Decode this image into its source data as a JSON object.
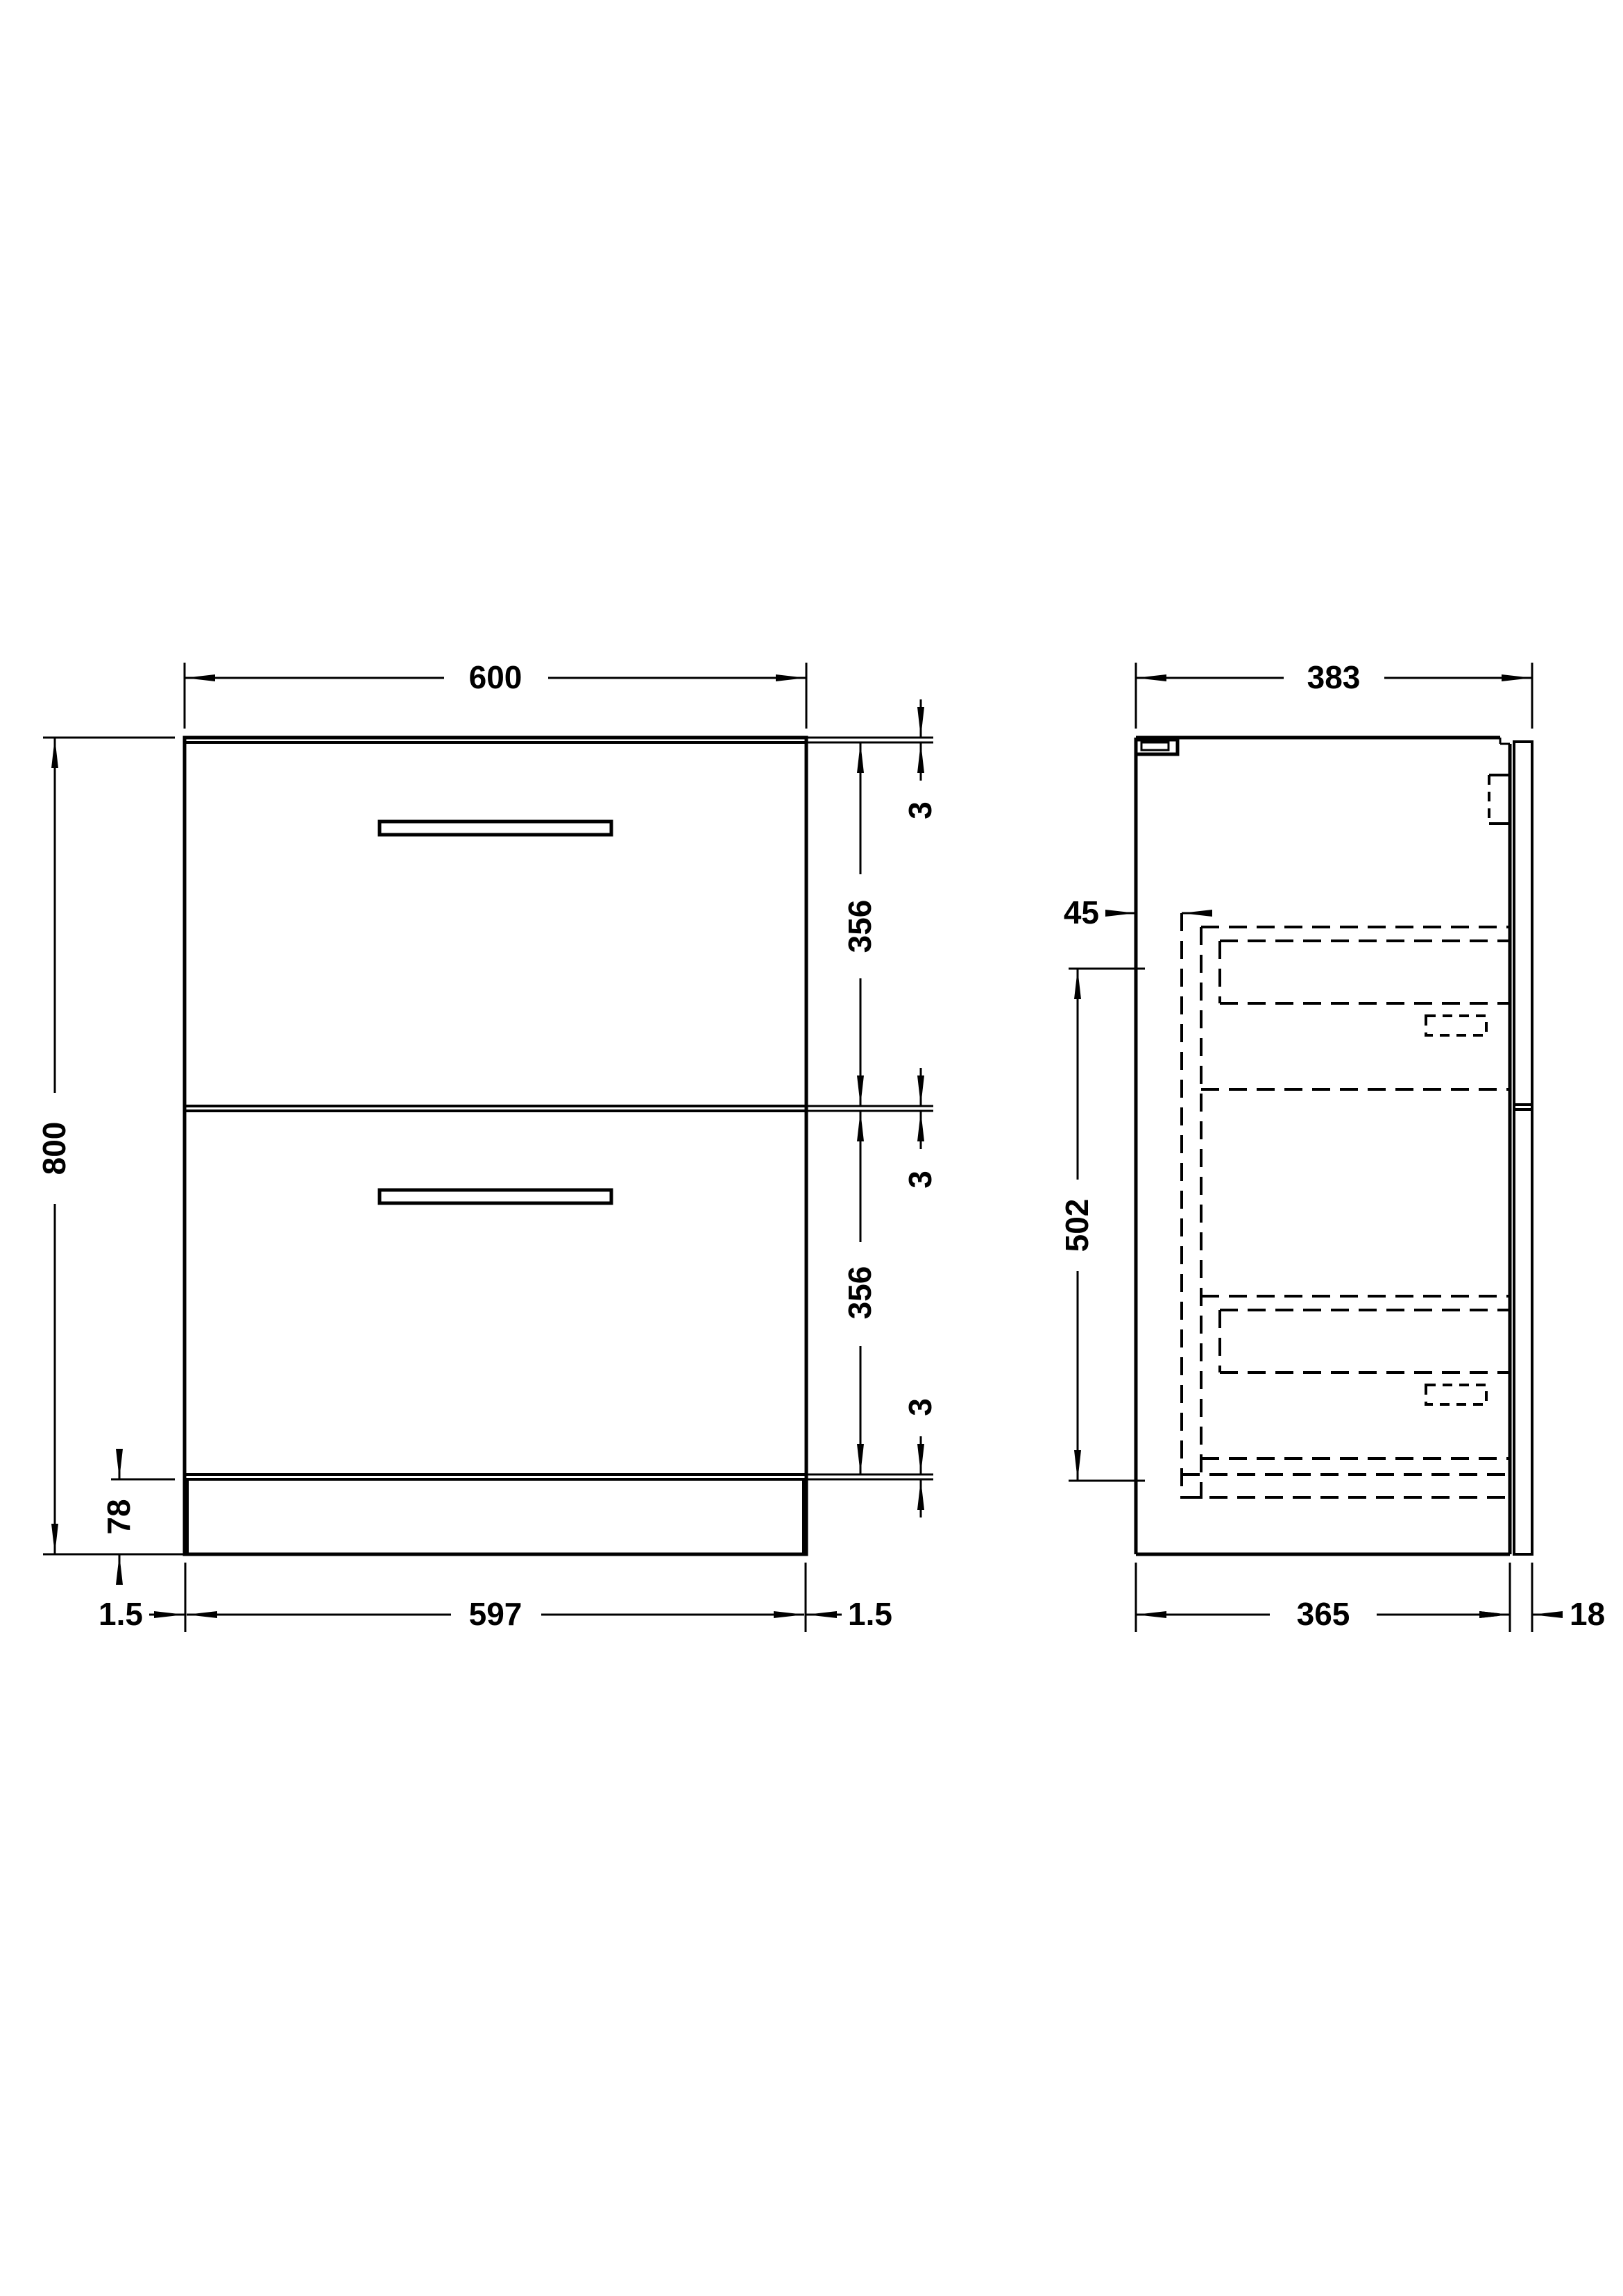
{
  "background_color": "#ffffff",
  "line_color": "#000000",
  "front_view": {
    "dim_width": "600",
    "dim_height": "800",
    "dim_top_gap": "3",
    "dim_drawer1_height": "356",
    "dim_middle_gap": "3",
    "dim_drawer2_height": "356",
    "dim_bottom_gap": "3",
    "dim_plinth_height": "78",
    "dim_plinth_inset_left": "1.5",
    "dim_plinth_width": "597",
    "dim_plinth_inset_right": "1.5"
  },
  "side_view": {
    "dim_depth": "383",
    "dim_drawer_setback": "45",
    "dim_internal_height": "502",
    "dim_carcass_depth": "365",
    "dim_back_panel": "18"
  }
}
